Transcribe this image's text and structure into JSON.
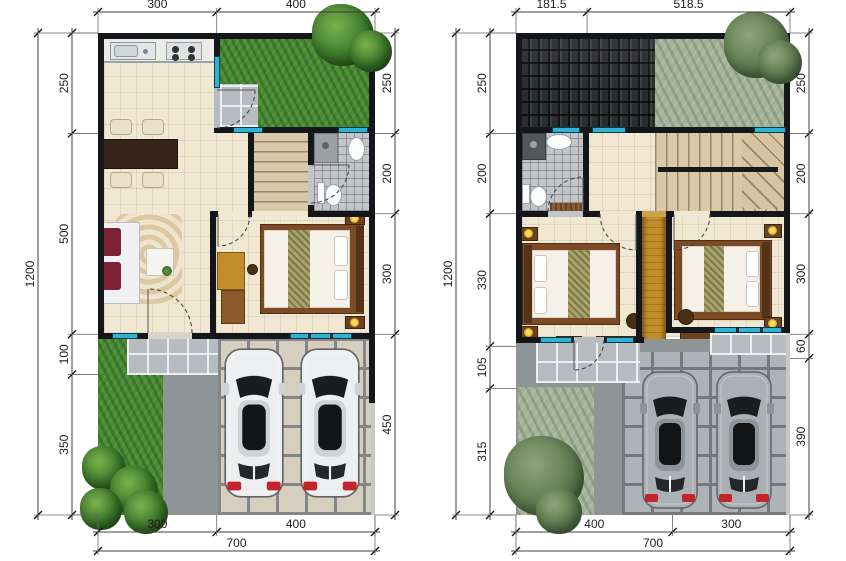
{
  "figure": {
    "type": "architectural-floor-plans",
    "background": "#ffffff",
    "units_implied": "cm"
  },
  "plans": [
    {
      "id": "ground-floor",
      "top": [
        "300",
        "400"
      ],
      "left": [
        "250",
        "500",
        "100",
        "350"
      ],
      "right": [
        "250",
        "200",
        "300",
        "450"
      ],
      "bottom": [
        "300",
        "400"
      ],
      "bottom_total": "700",
      "side_total_left": "1200"
    },
    {
      "id": "upper-floor",
      "top": [
        "181.5",
        "518.5"
      ],
      "left": [
        "250",
        "200",
        "330",
        "105",
        "315"
      ],
      "right": [
        "250",
        "200",
        "300",
        "60",
        "390"
      ],
      "bottom": [
        "400",
        "300"
      ],
      "bottom_total": "700",
      "side_total_left": "1200"
    }
  ],
  "colors": {
    "wall": "#15161a",
    "window": "#2fb2d6",
    "marble_floor": "#f1e8d4",
    "grass_green": "#4a8a35",
    "grass_sage": "#a4b399",
    "roof_dark": "#2a2c2e",
    "paver_beige": "#d6cfbf",
    "paver_gray": "#adb3b7",
    "concrete": "#8f9497",
    "wood_yellow": "#c28e2c",
    "wood_dark": "#6b4122",
    "sofa_accent": "#7c2136",
    "tail_light": "#c2242c",
    "dimension_text": "#1c1c1c"
  }
}
